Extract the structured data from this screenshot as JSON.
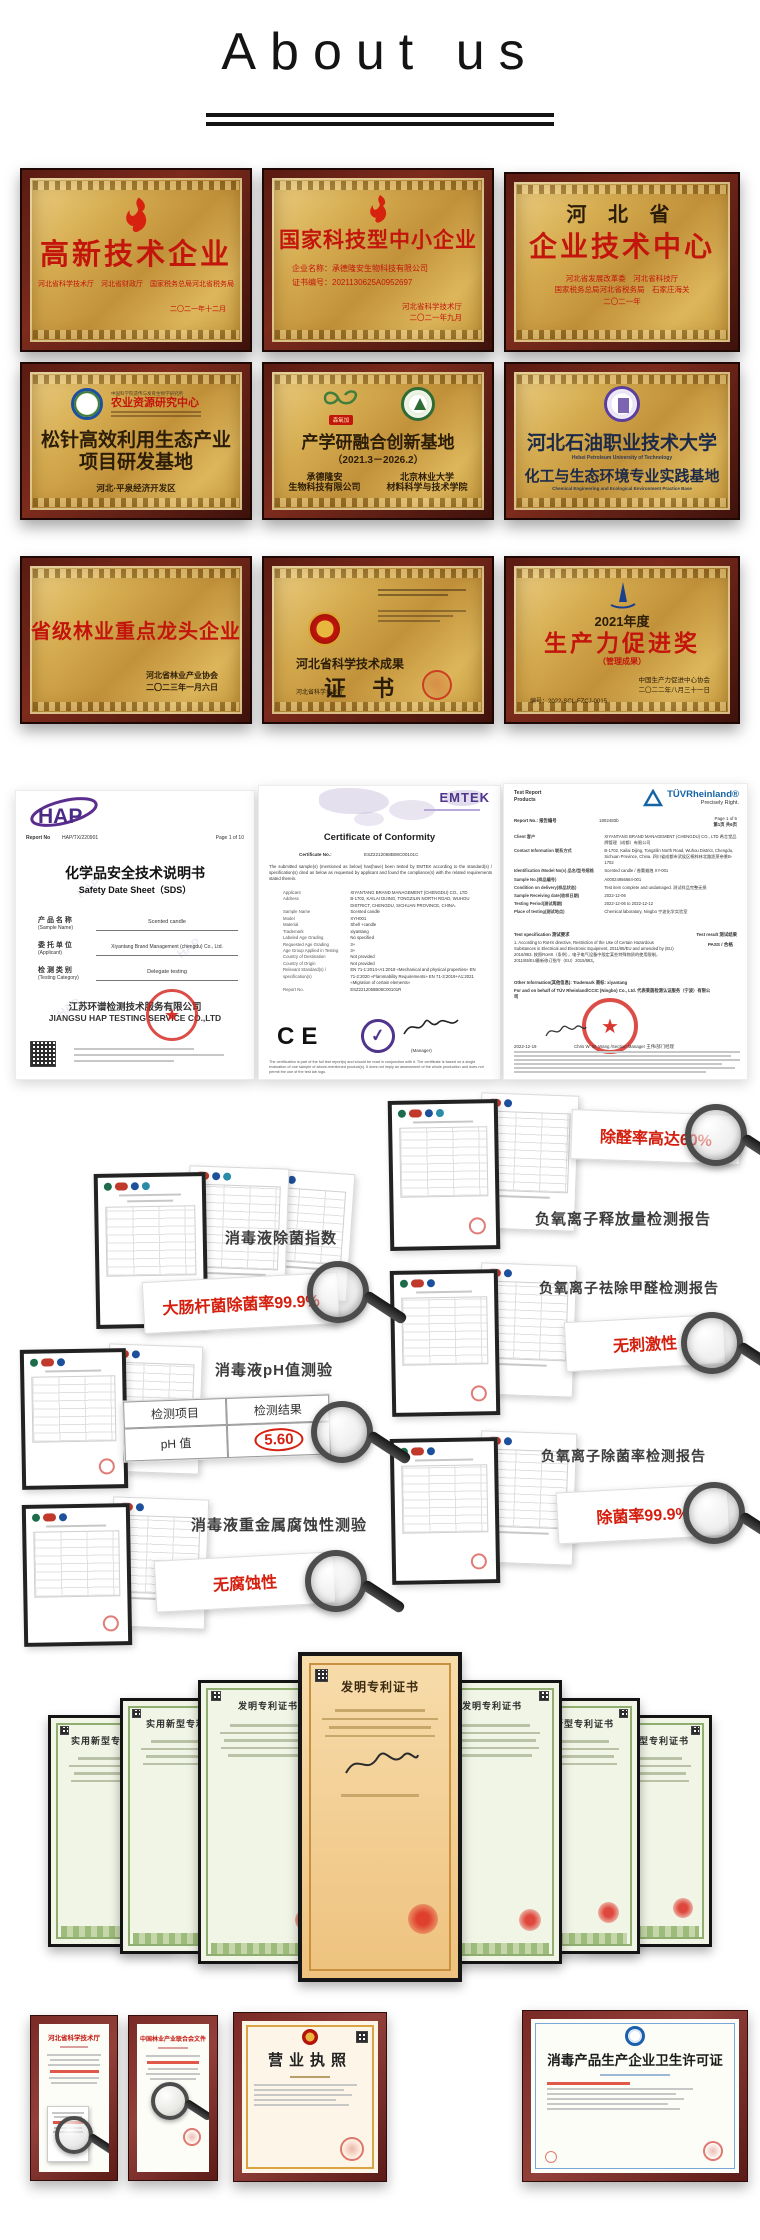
{
  "header": {
    "title": "About us"
  },
  "plaques": {
    "p1": {
      "title": "高新技术企业",
      "sub": "河北省科学技术厅　河北省财政厅　国家税务总局河北省税务局",
      "date": "二〇二一年十二月"
    },
    "p2": {
      "title": "国家科技型中小企业",
      "line1": "企业名称：承德隆安生物科技有限公司",
      "line2": "证书编号：2021130625A0952697",
      "issuer": "河北省科学技术厅",
      "date": "二〇二一年九月"
    },
    "p3": {
      "pre": "河 北 省",
      "title": "企业技术中心",
      "sub1": "河北省发展改革委　河北省科技厅",
      "sub2": "国家税务总局河北省税务局　石家庄海关",
      "date": "二〇二一年"
    },
    "p4": {
      "org_small": "中国科学院遗传与发育生物学研究所",
      "org": "农业资源研究中心",
      "title1": "松针高效利用生态产业",
      "title2": "项目研发基地",
      "sub": "河北·平泉经济开发区"
    },
    "p5": {
      "badge": "森氧加",
      "title": "产学研融合创新基地",
      "period": "（2021.3－2026.2）",
      "l1": "承德隆安",
      "l2": "生物科技有限公司",
      "r1": "北京林业大学",
      "r2": "材料科学与技术学院"
    },
    "p6": {
      "title": "河北石油职业技术大学",
      "title_en": "Hebei Petroleum University of Technology",
      "sub": "化工与生态环境专业实践基地",
      "sub_en": "Chemical Engineering and Ecological Environment Practice Base"
    },
    "p7": {
      "title": "省级林业重点龙头企业",
      "issuer": "河北省林业产业协会",
      "date": "二〇二三年一月六日"
    },
    "p8": {
      "title": "河北省科学技术成果",
      "cert": "证 书",
      "issuer": "河北省科学技术厅"
    },
    "p9": {
      "year": "2021年度",
      "title": "生产力促进奖",
      "sub": "（管理成果）",
      "issuer": "中国生产力促进中心协会",
      "date": "二〇二二年八月三十一日",
      "no": "编号：2022-SCL-FZCJ-0015"
    }
  },
  "sds": {
    "logo": "HAP",
    "report_label": "Report No",
    "report_no": "HAP/TX/220901",
    "page": "Page 1 of 10",
    "title_cn": "化学品安全技术说明书",
    "title_en": "Safety Date Sheet（SDS）",
    "f1_cn": "产 品 名 称",
    "f1_en": "(Sample Name)",
    "f1_v": "Scented candle",
    "f2_cn": "委 托 单 位",
    "f2_en": "(Applicant)",
    "f2_v": "Xiyantang Brand Management (chengdu) Co., Ltd.",
    "f3_cn": "检 测 类 别",
    "f3_en": "(Testing Category)",
    "f3_v": "Delegate testing",
    "company_cn": "江苏环谱检测技术服务有限公司",
    "company_en": "JIANGSU HAP TESTING SERVICE CO.,LTD"
  },
  "coc": {
    "brand": "EMTEK",
    "title": "Certificate of Conformity",
    "cert_no_label": "Certificate No.:",
    "cert_no": "ESZ2212058B08C00101C",
    "intro": "The submitted sample(s) (mentioned as below) has(have) been tested by EMTEK according to the standard(s) / specification(s) cited as below as requested by applicant and found the compliance(s) with the related requirements stated therein.",
    "fields": [
      {
        "k": "Applicant",
        "v": "XIYANTANG BRAND MANAGEMENT (CHENGDU) CO., LTD"
      },
      {
        "k": "Address",
        "v": "B-1702, KAILAI DIJING, TONGZILIN NORTH ROAD, WUHOU DISTRICT, CHENGDU, SICHUAN PROVINCE, CHINA."
      },
      {
        "k": "Sample Name",
        "v": "Scented candle"
      },
      {
        "k": "Model",
        "v": "XYH001"
      },
      {
        "k": "Material",
        "v": "Shell +candle"
      },
      {
        "k": "Trademark",
        "v": "xiyantang"
      },
      {
        "k": "Labeled Age Grading",
        "v": "No specified"
      },
      {
        "k": "Requested Age Grading",
        "v": "3+"
      },
      {
        "k": "Age Group Applied in Testing",
        "v": "3+"
      },
      {
        "k": "Country of Destination",
        "v": "Not provided"
      },
      {
        "k": "Country of Origin",
        "v": "Not provided"
      },
      {
        "k": "Relevant Standard(s) / specification(s)",
        "v": "EN 71-1:2014+A1:2018 «Mechanical and physical properties»  EN 71-2:2020 «Flammability Requirements»  EN 71-3:2019+A1:2021 «Migration of certain elements»"
      },
      {
        "k": "Report No.",
        "v": "ESZ2212058B08C00101R"
      }
    ],
    "ce": "CE",
    "sig_role": "(Manager)",
    "footer": "The certification is part of the full test report(s) and should be read in conjunction with it. The certificate is based on a single evaluation of one sample of above-mentioned product(s). It does not imply an assessment of the whole production and does not permit the use of the test lab logo."
  },
  "tuv": {
    "doc_type1": "Test Report",
    "doc_type2": "Products",
    "brand": "TÜVRheinland®",
    "slogan": "Precisely Right.",
    "report_label": "Report No.: 报告编号",
    "report_no": "1802483b",
    "page": "Page 1 of 6",
    "page_cn": "第1页 共6页",
    "rows": [
      {
        "k": "Client 客户",
        "v": "XIYANTANG BRAND MANAGEMENT (CHENGDU) CO., LTD 希言堂品牌管理（成都）有限公司"
      },
      {
        "k": "Contact Information 联系方式",
        "v": "B-1702, Kailai Dijing, Tongzilin North Road, Wuhou District, Chengdu, Sichuan Province, China. 四川省成都市武侯区桐梓林北路凯莱帝景B-1702"
      },
      {
        "k": "Identification /Model No(s) 品名/型号规格",
        "v": "Scented candle / 香薰蜡烛  XY-001"
      },
      {
        "k": "Sample No.(样品编号)",
        "v": "A00024956664-001"
      },
      {
        "k": "Condition on delivery(样品状态)",
        "v": "Test item complete and undamaged. 测试样品完整无损"
      },
      {
        "k": "Sample Receiving date(收样日期)",
        "v": "2022-12-06"
      },
      {
        "k": "Testing Period(测试周期)",
        "v": "2022-12-06 to 2022-12-12"
      },
      {
        "k": "Place of testing(测试地点)",
        "v": "Chemical laboratory, Ningbo 宁波化学实验室"
      }
    ],
    "spec_label": "Test specification 测试要求",
    "result_label": "Test result 测试结果",
    "spec": "1. According to RoHS directive, Restriction of the Use of Certain Hazardous Substances in Electrical and Electronic Equipment, 2011/65/EU and amended by (EU) 2015/863. 按照RoHS（条例），电子电气设备中限定某些特殊物质的使用限制，2011/65/EU最新修订指令（EU）2015/863。",
    "result": "PASS / 合格",
    "other": "Other Information(其他信息): Trademark 商标: xiyantang",
    "behalf": "For and on behalf of TÜV Rheinland/CCIC (Ningbo) Co., Ltd. 代表莱茵检测认证服务（宁波）有限公司",
    "date": "2022-12-19",
    "signer": "Chris W. W. Wang /Section Manager 王伟/部门经理"
  },
  "reports": {
    "left": [
      {
        "label": "消毒液除菌指数",
        "zoom": "大肠杆菌除菌率99.9%"
      },
      {
        "label": "消毒液pH值测验",
        "th1": "检测项目",
        "th2": "检测结果",
        "td1": "pH 值",
        "td2": "5.60"
      },
      {
        "label": "消毒液重金属腐蚀性测验",
        "zoom": "无腐蚀性"
      }
    ],
    "right": [
      {
        "label": "负氧离子释放量检测报告",
        "zoom": "除醛率高达60%"
      },
      {
        "label": "负氧离子祛除甲醛检测报告",
        "zoom": "无刺激性"
      },
      {
        "label": "负氧离子除菌率检测报告",
        "zoom": "除菌率99.9%"
      }
    ]
  },
  "patents": {
    "c0": "实用新型专利证书",
    "c1": "实用新型专利证书",
    "c2": "发明专利证书",
    "c3": "发明专利证书",
    "c4": "发明专利证书",
    "c5": "实用新型专利证书",
    "c6": "实用新型专利证书"
  },
  "bottom": {
    "b1_title": "河北省科学技术厅",
    "b2_title": "中国林业产业联合会文件",
    "b3_title": "营业执照",
    "b4_title": "消毒产品生产企业卫生许可证"
  },
  "colors": {
    "gold": "#c9a348",
    "frame_maroon": "#5a1b12",
    "red": "#c3150c",
    "tuv_blue": "#1464a5",
    "hap_purple": "#5b2d8e",
    "emtek_purple": "#6b4fa0"
  }
}
